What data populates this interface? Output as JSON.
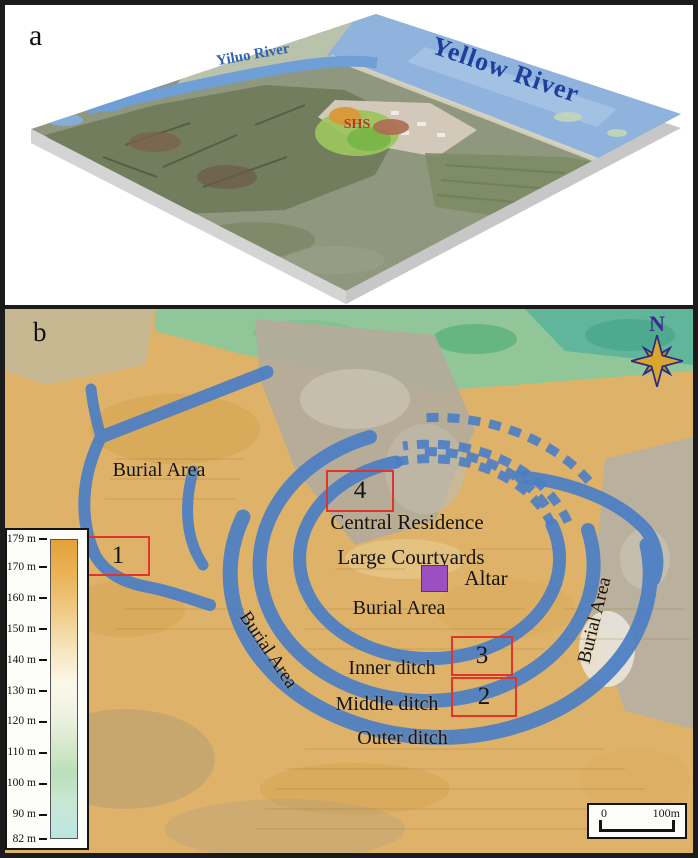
{
  "figure": {
    "panel_a": {
      "label": "a",
      "yiluo_river": "Yiluo River",
      "yellow_river": "Yellow River",
      "site": "SHS"
    },
    "panel_b": {
      "label": "b",
      "north": "N",
      "labels": {
        "burial_nw": "Burial Area",
        "burial_center": "Burial Area",
        "burial_west": "Burial Area",
        "burial_east": "Burial Area",
        "central_residence": "Central Residence",
        "large_courtyards": "Large Courtyards",
        "altar": "Altar",
        "inner_ditch": "Inner ditch",
        "middle_ditch": "Middle ditch",
        "outer_ditch": "Outer ditch"
      },
      "markers": [
        {
          "label": "1"
        },
        {
          "label": "2"
        },
        {
          "label": "3"
        },
        {
          "label": "4"
        }
      ],
      "legend": {
        "ticks": [
          "179 m",
          "170 m",
          "160 m",
          "150 m",
          "140 m",
          "130 m",
          "120 m",
          "110 m",
          "100 m",
          "90 m",
          "82 m"
        ]
      },
      "scale_bar": {
        "start": "0",
        "end": "100m"
      },
      "colors": {
        "ditch_blue": "#4b7ec5",
        "marker_red": "#e0352c",
        "altar_purple": "#9b4fc0",
        "elevation_top": "#e5a138",
        "elevation_bottom": "#bce6e3"
      }
    }
  }
}
